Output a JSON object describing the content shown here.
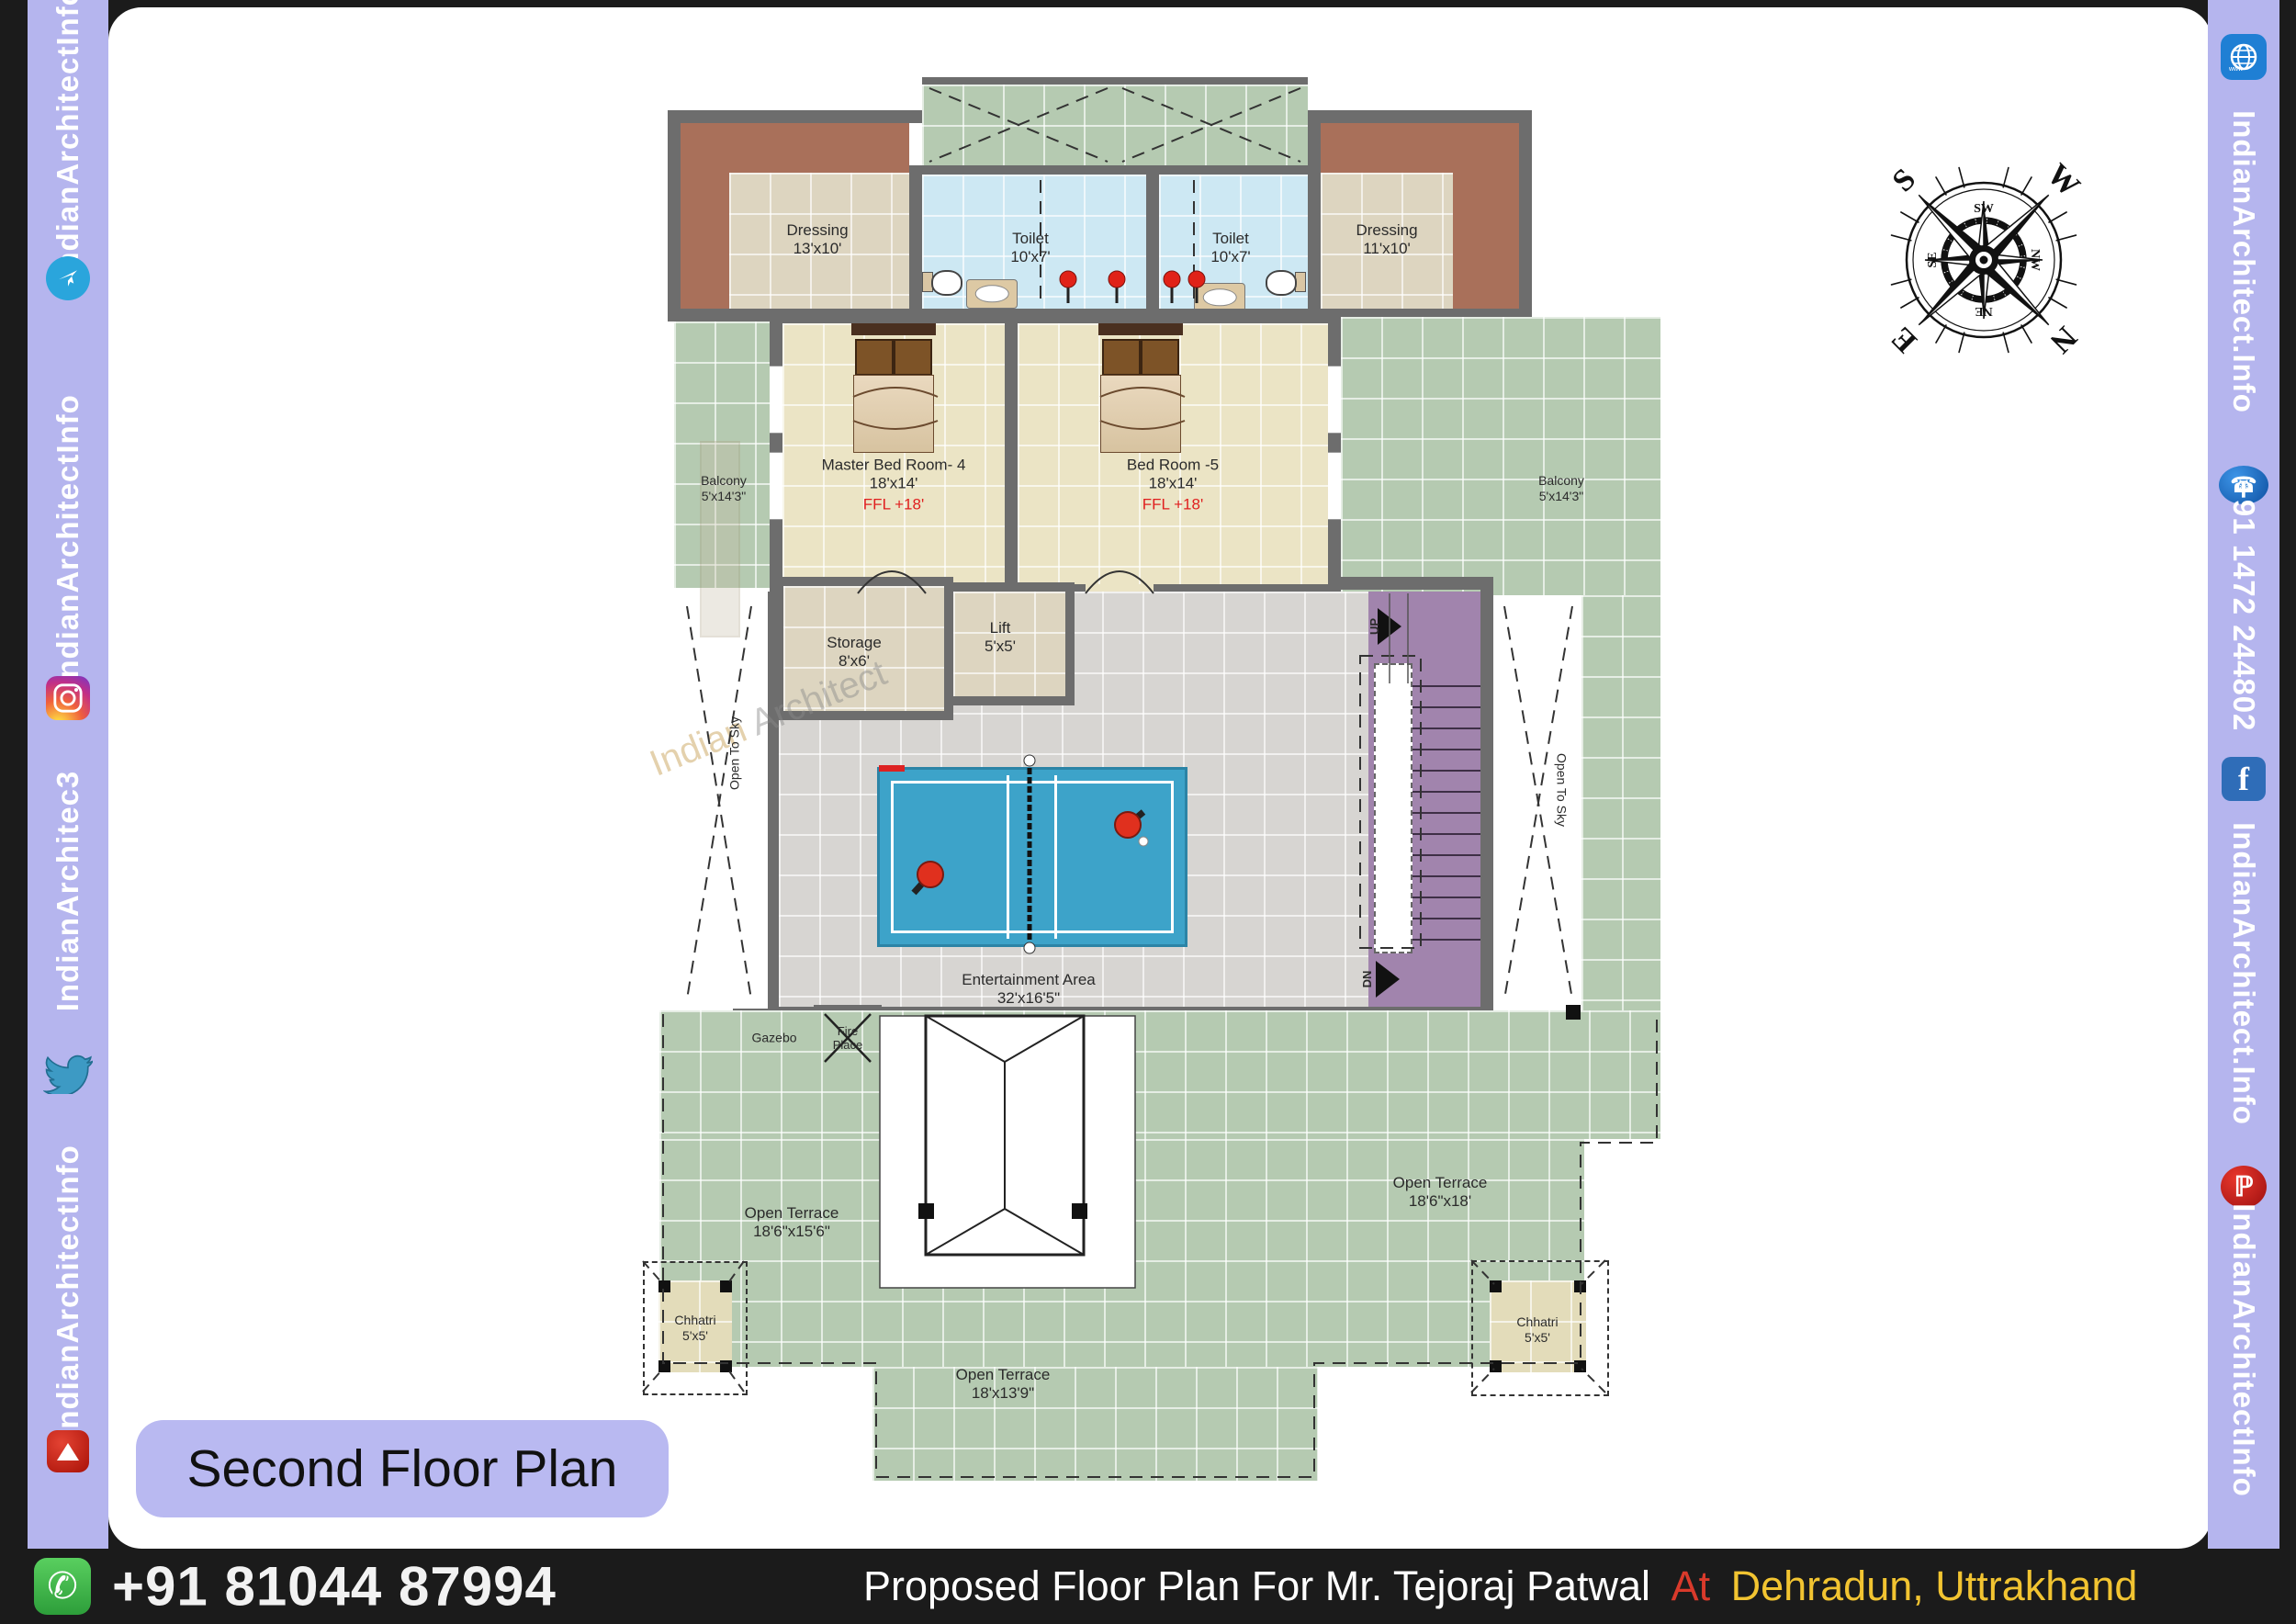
{
  "plan_title": "Second Floor Plan",
  "left_sidebar": {
    "text1": "IndianArchitectInfo",
    "text2": "IndianArchitectInfo",
    "text3": "IndianArchitec3",
    "text4": "IndianArchitectInfo"
  },
  "right_sidebar": {
    "www": "www",
    "text1": "IndianArchitect.Info",
    "phone": "+91 1472 244802",
    "text2": "IndianArchitect.Info",
    "text3": "IndianArchitectInfo"
  },
  "footer": {
    "whatsapp_number": "+91 81044 87994",
    "title_white": "Proposed Floor Plan For Mr. Tejoraj Patwal",
    "title_red": "At",
    "title_yellow": "Dehradun, Uttrakhand"
  },
  "watermark": {
    "line1": "Indian",
    "line2": "Architect"
  },
  "compass": {
    "n": "N",
    "s": "S",
    "e": "E",
    "w": "W",
    "ne": "NE",
    "nw": "NW",
    "se": "SE",
    "sw": "SW"
  },
  "rooms": {
    "dressing_left": {
      "name": "Dressing",
      "size": "13'x10'"
    },
    "toilet_left": {
      "name": "Toilet",
      "size": "10'x7'"
    },
    "toilet_right": {
      "name": "Toilet",
      "size": "10'x7'"
    },
    "dressing_right": {
      "name": "Dressing",
      "size": "11'x10'"
    },
    "balcony_left": {
      "name": "Balcony",
      "size": "5'x14'3\""
    },
    "balcony_right": {
      "name": "Balcony",
      "size": "5'x14'3\""
    },
    "master_bedroom": {
      "name": "Master Bed Room- 4",
      "size": "18'x14'",
      "ffl": "FFL +18'"
    },
    "bedroom5": {
      "name": "Bed Room -5",
      "size": "18'x14'",
      "ffl": "FFL +18'"
    },
    "storage": {
      "name": "Storage",
      "size": "8'x6'"
    },
    "lift": {
      "name": "Lift",
      "size": "5'x5'"
    },
    "entertainment": {
      "name": "Entertainment Area",
      "size": "32'x16'5\""
    },
    "gazebo": {
      "name": "Gazebo"
    },
    "fireplace": {
      "line1": "Fire",
      "line2": "Place"
    },
    "open_to_sky_left": {
      "name": "Open To Sky"
    },
    "open_to_sky_right": {
      "name": "Open To Sky"
    },
    "terrace_left": {
      "name": "Open Terrace",
      "size": "18'6\"x15'6\""
    },
    "terrace_right": {
      "name": "Open Terrace",
      "size": "18'6\"x18'"
    },
    "terrace_bottom": {
      "name": "Open Terrace",
      "size": "18'x13'9\""
    },
    "chhatri_left": {
      "name": "Chhatri",
      "size": "5'x5'"
    },
    "chhatri_right": {
      "name": "Chhatri",
      "size": "5'x5'"
    },
    "stairs": {
      "up": "UP",
      "dn": "DN"
    }
  }
}
